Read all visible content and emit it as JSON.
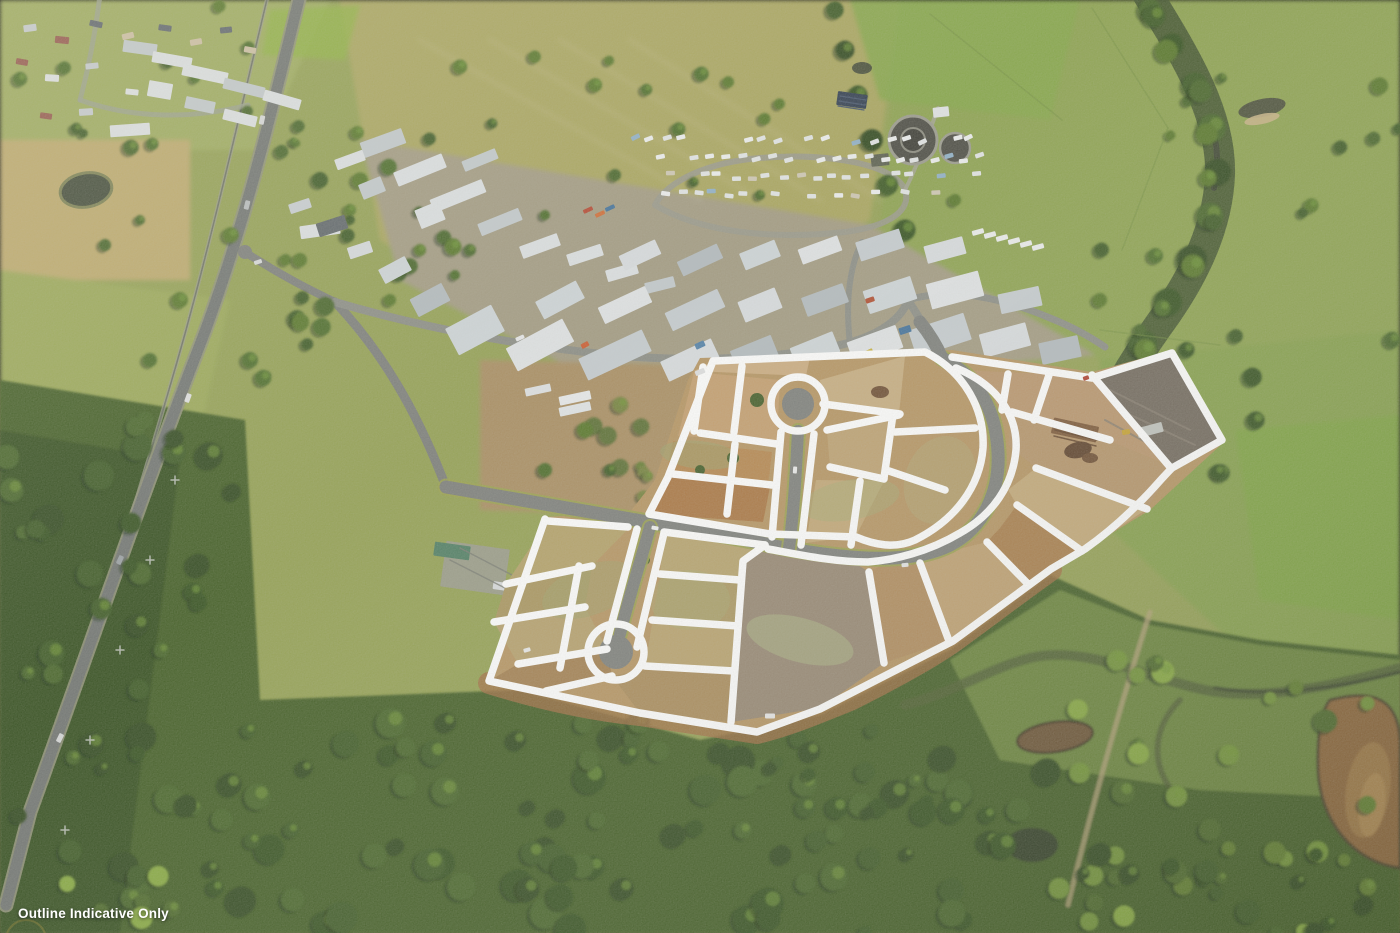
{
  "caption": {
    "text": "Outline Indicative Only"
  },
  "overlay": {
    "type": "lot-boundary-outline",
    "stroke_color": "#ffffff"
  },
  "scene_features": [
    "township",
    "industrial-estate",
    "caravan-storage-yard",
    "water-treatment-plant",
    "highway",
    "creek-corridor",
    "bushland",
    "farm-dams",
    "land-estate-earthworks",
    "lot-boundaries"
  ],
  "palette": {
    "baseGreen": "#93a051",
    "suburbGreen": "#9dab5b",
    "paddockOlive": "#a9a55c",
    "fieldTan": "#bda96a",
    "grassGreen": "#8ca24d",
    "grassDeep": "#85a04a",
    "grassBright": "#7da33f",
    "sportsGreen": "#84a647",
    "industrialGround": "#a29a80",
    "dirtFringe": "#a98d60",
    "bushDark": "#33491d",
    "bushMid": "#405c20",
    "bushDeep": "#2c421a",
    "wetlandGreen": "#6e8a3e",
    "roadGrey": "#7b7d79",
    "asphalt": "#6f7370",
    "roadLight": "#8a8c84",
    "verge": "#98a04b",
    "roofWhite": "#dde1e3",
    "roofGrey": "#c3cacd",
    "estateDirt": "#b5935f",
    "dirtOrange": "#a9713f",
    "dirtBatter": "#a06a3e",
    "dirtLight": "#c4a377",
    "dirtPale": "#cdb58d",
    "greyLot": "#6f665a",
    "balanceGrey": "#958570",
    "waterDark": "#3f4836",
    "waterBrown": "#8a6234",
    "pondBrown": "#6b5130",
    "outlineWhite": "#ffffff",
    "captionText": "#ffffff"
  }
}
